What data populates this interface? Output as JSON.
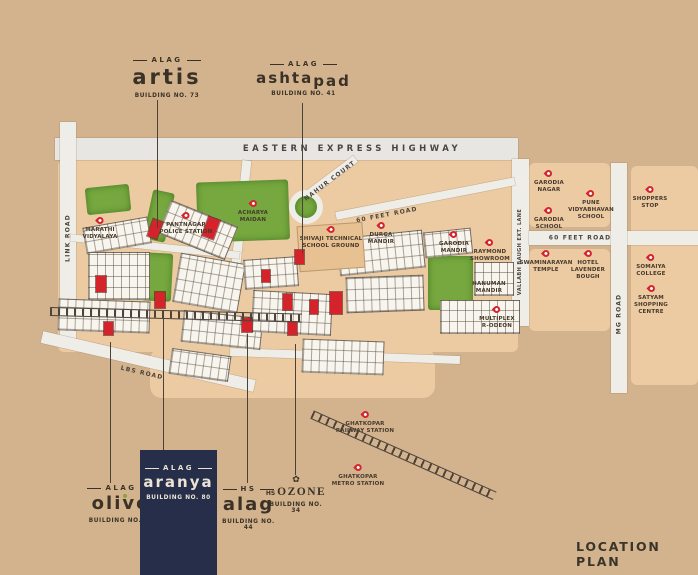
{
  "title": "LOCATION PLAN",
  "colors": {
    "background": "#d3b38d",
    "pin_red": "#d5232b",
    "park_green": "#76a83f",
    "navy": "#272e4a",
    "text_dark": "#3a3226"
  },
  "projects": {
    "artis": {
      "brand": "ALAG",
      "name": "artis",
      "building": "BUILDING NO. 73"
    },
    "ashtapad": {
      "brand": "ALAG",
      "name_main": "ashta",
      "name_sub": "pad",
      "building": "BUILDING NO. 41"
    },
    "olive": {
      "brand": "ALAG",
      "name": "olive",
      "building": "BUILDING NO. 93"
    },
    "aranya": {
      "brand": "ALAG",
      "name": "aranya",
      "building": "BUILDING NO. 80"
    },
    "hs_alag": {
      "brand": "HS",
      "name": "alag",
      "building": "BUILDING NO. 44"
    },
    "hs_ozone": {
      "brand": "HS",
      "name": "OZONE",
      "building": "BUILDING NO. 34",
      "rose_icon": "✿"
    }
  },
  "map": {
    "roads": [
      {
        "id": "eastern-express-highway",
        "label": "EASTERN EXPRESS HIGHWAY",
        "x": 352,
        "y": 149,
        "rot": 0,
        "size": "lg"
      },
      {
        "id": "link-road",
        "label": "LINK ROAD",
        "x": 68,
        "y": 238,
        "rot": -90
      },
      {
        "id": "lbs-road",
        "label": "LBS ROAD",
        "x": 142,
        "y": 373,
        "rot": 13
      },
      {
        "id": "60-feet-road-inner",
        "label": "60 FEET ROAD",
        "x": 387,
        "y": 215,
        "rot": -11
      },
      {
        "id": "nahur-court",
        "label": "NAHUR COURT",
        "x": 330,
        "y": 181,
        "rot": -37
      },
      {
        "id": "60-feet-road-east",
        "label": "60 FEET ROAD",
        "x": 580,
        "y": 238,
        "rot": 0
      },
      {
        "id": "mg-road",
        "label": "MG ROAD",
        "x": 619,
        "y": 314,
        "rot": -90
      },
      {
        "id": "vallabh-baugh-lane",
        "label": "VALLABH BAUGH EXT. LANE",
        "x": 520,
        "y": 252,
        "rot": -90,
        "size": "sm"
      }
    ],
    "landmarks": [
      {
        "id": "marathi-vidyalaya",
        "label": "MARATHI\nVIDYALAYA",
        "x": 100,
        "y": 217,
        "pin": true
      },
      {
        "id": "pantnagar-police-station",
        "label": "PANTNAGAR\nPOLICE STATION",
        "x": 186,
        "y": 212,
        "pin": true
      },
      {
        "id": "acharya-maidan",
        "label": "ACHARYA\nMAIDAN",
        "x": 253,
        "y": 200,
        "pin": true
      },
      {
        "id": "shivaji-technical-school-ground",
        "label": "SHIVAJI TECHNICAL\nSCHOOL GROUND",
        "x": 331,
        "y": 226,
        "pin": true
      },
      {
        "id": "durga-mandir",
        "label": "DURGA\nMANDIR",
        "x": 381,
        "y": 222,
        "pin": true
      },
      {
        "id": "garodia-mandir",
        "label": "GARODIA\nMANDIR",
        "x": 454,
        "y": 231,
        "pin": true
      },
      {
        "id": "raymond-showroom",
        "label": "RAYMOND\nSHOWROOM",
        "x": 490,
        "y": 239,
        "pin": true
      },
      {
        "id": "hanuman-mandir",
        "label": "HANUMAN\nMANDIR",
        "x": 489,
        "y": 281,
        "pin": false
      },
      {
        "id": "multiplex-r-odeon",
        "label": "MULTIPLEX\nR-ODEON",
        "x": 497,
        "y": 306,
        "pin": true
      },
      {
        "id": "garodia-nagar",
        "label": "GARODIA\nNAGAR",
        "x": 549,
        "y": 170,
        "pin": true
      },
      {
        "id": "garodia-school",
        "label": "GARODIA\nSCHOOL",
        "x": 549,
        "y": 207,
        "pin": true
      },
      {
        "id": "pune-vidyabhavan-school",
        "label": "PUNE\nVIDYABHAVAN\nSCHOOL",
        "x": 591,
        "y": 190,
        "pin": true
      },
      {
        "id": "swaminarayan-temple",
        "label": "SWAMINARAYAN\nTEMPLE",
        "x": 546,
        "y": 250,
        "pin": true
      },
      {
        "id": "hotel-lavender-bough",
        "label": "HOTEL\nLAVENDER\nBOUGH",
        "x": 588,
        "y": 250,
        "pin": true
      },
      {
        "id": "shoppers-stop",
        "label": "SHOPPERS\nSTOP",
        "x": 650,
        "y": 186,
        "pin": true
      },
      {
        "id": "somaiya-college",
        "label": "SOMAIYA\nCOLLEGE",
        "x": 651,
        "y": 254,
        "pin": true
      },
      {
        "id": "satyam-shopping-centre",
        "label": "SATYAM\nSHOPPING\nCENTRE",
        "x": 651,
        "y": 285,
        "pin": true
      },
      {
        "id": "ghatkopar-railway-station",
        "label": "GHATKOPAR\nRAILWAY STATION",
        "x": 365,
        "y": 411,
        "pin": true
      },
      {
        "id": "ghatkopar-metro-station",
        "label": "GHATKOPAR\nMETRO STATION",
        "x": 358,
        "y": 464,
        "pin": true
      }
    ]
  }
}
